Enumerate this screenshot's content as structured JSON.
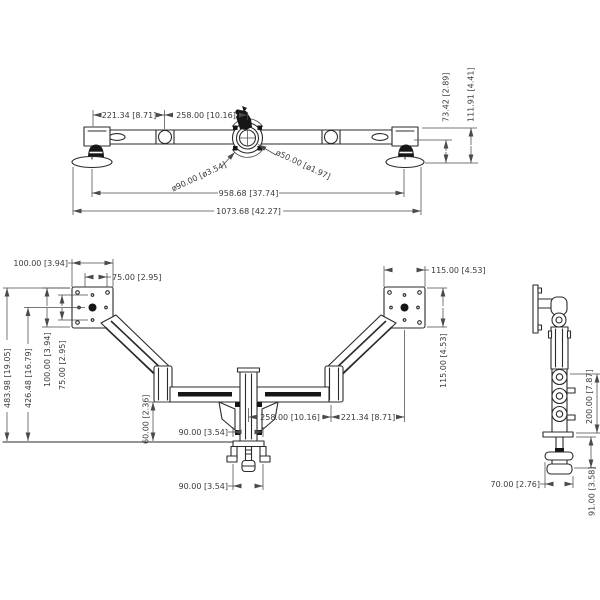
{
  "views": {
    "top": {
      "dims": {
        "seg_left": "221.34 [8.71]",
        "seg_mid": "258.00 [10.16]",
        "dia_outer": "ø90.00 [ø3.54]",
        "dia_inner": "ø50.00 [ø1.97]",
        "span_inner": "958.68 [37.74]",
        "span_outer": "1073.68 [42.27]",
        "height_arm": "73.42 [2.89]",
        "height_total": "111.91 [4.41]"
      }
    },
    "front": {
      "dims": {
        "left_plate_w": "100.00 [3.94]",
        "left_holes_w": "75.00 [2.95]",
        "left_plate_h": "100.00 [3.94]",
        "left_holes_h": "75.00 [2.95]",
        "total_h": "483.98 [19.05]",
        "arm_h": "426.48 [16.79]",
        "right_plate_w": "115.00 [4.53]",
        "right_plate_h": "115.00 [4.53]",
        "seg_mid": "258.00 [10.16]",
        "seg_outer": "221.34 [8.71]",
        "clamp_top_w": "90.00 [3.54]",
        "desk_range": "60.00 [2.36]",
        "clamp_bot_w": "90.00 [3.54]"
      }
    },
    "side": {
      "dims": {
        "pole_h": "200.00 [7.87]",
        "foot_w": "70.00 [2.76]",
        "under_h": "91.00 [3.58]"
      }
    }
  }
}
